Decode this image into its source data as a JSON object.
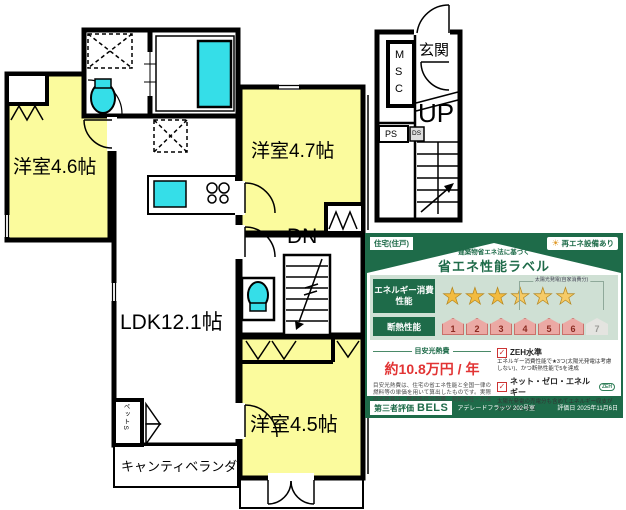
{
  "floor_plan": {
    "room_a_label": "洋室4.6帖",
    "room_b_label": "洋室4.7帖",
    "room_c_label": "洋室4.5帖",
    "ldk_label": "LDK12.1帖",
    "veranda_label": "キャンティベランダ",
    "entrance_label": "玄関",
    "stairs_up_label": "UP",
    "stairs_down_label": "DN",
    "msc_label": "MSC",
    "ps_label": "PS",
    "ds_label": "DS",
    "pet_storage_label": "ペットS"
  },
  "energy_label": {
    "building_type": "住宅(住戸)",
    "renewable_badge": "再エネ設備あり",
    "law_note": "建築物省エネ法に基づく",
    "title": "省エネ性能ラベル",
    "energy_row_label": "エネルギー消費性能",
    "stars": {
      "filled": 3,
      "total": 6,
      "glyph": "★",
      "solar_note": "太陽光発電(自家消費分)"
    },
    "insulation_row_label": "断熱性能",
    "insulation": {
      "levels": [
        "1",
        "2",
        "3",
        "4",
        "5",
        "6",
        "7"
      ],
      "achieved": 6
    },
    "cost_heading": "目安光熱費",
    "cost_value": "約10.8万円 / 年",
    "cost_note": "目安光熱費は、住宅の省エネ性能と全国一律の燃料等の単価を用いて算出したものです。実際の光熱費は、使用条件や設備、契約会社・方法などにより異なります。",
    "zeh_level": {
      "label": "ZEH水準",
      "desc": "エネルギー消費性能で★3つ(太陽光発電は考慮しない)、かつ断熱性能で5を達成"
    },
    "net_zero": {
      "label": "ネット・ゼロ・エネルギー",
      "badge": "ZEH",
      "desc": "太陽光発電の売電分も含めてエネルギー収支がゼロ以下を達成"
    },
    "evaluation": {
      "label": "第三者評価",
      "brand": "BELS",
      "building": "アデレードフラッツ 202号室",
      "date": "評価日 2025年11月6日"
    }
  },
  "colors": {
    "green": "#1e6b49",
    "light_green": "#cfe0d4",
    "star_gold": "#f3bb3f",
    "badge_pink": "#eba9a4",
    "badge_gray": "#e4e4e0",
    "cost_red": "#e23434",
    "room_yellow": "#fbfb9d",
    "fixture_cyan": "#35dee8",
    "wall_black": "#000000"
  }
}
